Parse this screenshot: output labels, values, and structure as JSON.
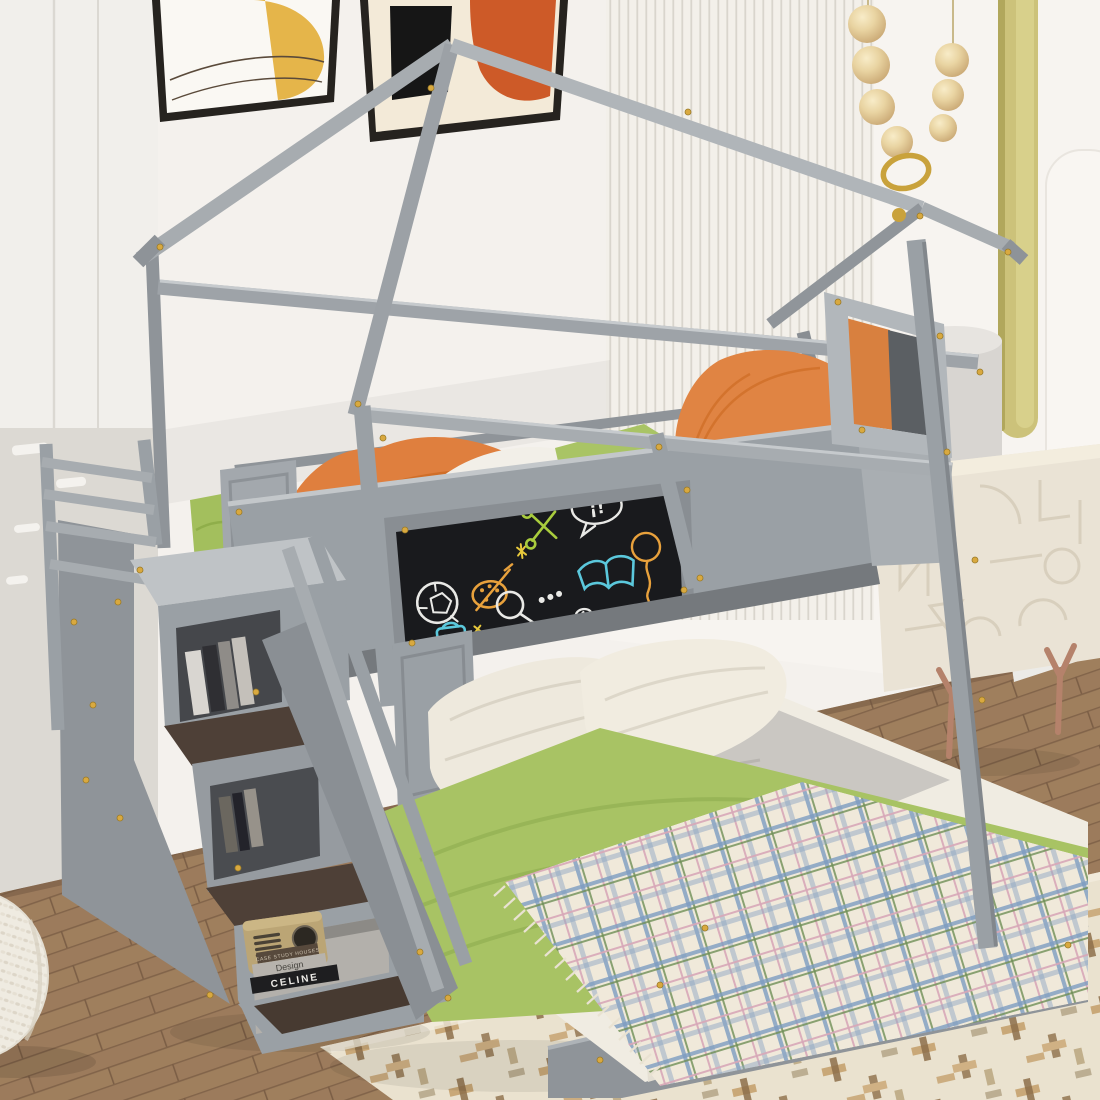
{
  "image_type": "product-lifestyle-photo",
  "subject": "Gray wooden house-shaped twin-over-full bunk loft bed with storage staircase, chalkboard guardrail panel and decorative kids bedroom scene",
  "texts": {
    "book_1": "CASE STUDY HOUSES",
    "book_2": "Design",
    "book_3": "CELINE",
    "chalk_bubble": "¡!"
  },
  "palette": {
    "bed_frame_gray": "#9aa0a5",
    "bed_frame_light": "#c3c7ca",
    "bed_frame_dark": "#7e8388",
    "hardware_gold": "#d9a93f",
    "chalkboard": "#191a1d",
    "chalk_white": "#e9e9e6",
    "chalk_blue": "#5bc8dc",
    "chalk_green": "#a9cc3d",
    "chalk_orange": "#e8a13c",
    "bedding_green": "#a8c364",
    "bedding_orange": "#df7f3e",
    "bedding_white": "#f0ece2",
    "sheet_gray": "#cac7c2",
    "plaid_base": "#f0e9da",
    "plaid_blue": "#7d9cc0",
    "plaid_green": "#6f8f56",
    "plaid_pink": "#d8a8b8",
    "wall": "#f4f1ed",
    "accent_niche_olive": "#ccc27a",
    "wood_floor": "#9c7b5c",
    "rug_cream": "#eae2cf",
    "nightstand_cream": "#eae3d5",
    "nightstand_leg_copper": "#b5826b",
    "bead_cream": "#e9d4a2",
    "gold_ring": "#c9a23c",
    "radio_tan": "#bba575",
    "art_yellow": "#e5b54a",
    "art_orange": "#cd5a28"
  },
  "scene": {
    "wall_art": [
      {
        "name": "abstract print, yellow blob with thin curved lines",
        "frame": "black"
      },
      {
        "name": "abstract print, black bar and orange shape",
        "frame": "black"
      }
    ],
    "decor": [
      "wood bead garland with gold ring",
      "olive recessed wall niche",
      "white pedestal cylinder",
      "cream geometric-pattern nightstand with copper Y legs",
      "white knit pouf",
      "cream patterned area rug",
      "walnut wood plank floor",
      "white slat accent wall",
      "white wardrobe with groove panels"
    ],
    "bed": {
      "frame": "gray house gable frame with gold screw accents",
      "top_bunk_bedding": [
        "green pillow",
        "orange blanket",
        "white duvet",
        "green blanket",
        "orange wedge pillow at window end"
      ],
      "guardrail": "black chalkboard panel with colorful chalk doodles",
      "chalk_doodles": [
        "soccer ball",
        "paint palette with brush",
        "sparkle stars",
        "green scissors",
        "speech bubble",
        "blue open book",
        "balloon",
        "magnifying glass with dots",
        "blue backpack",
        "paperclip"
      ],
      "window": "small gray window frame at foot end",
      "bottom_bunk": [
        "two cream pillows",
        "gray sheet",
        "green blanket",
        "plaid fringe throw",
        "white full mattress",
        "gray platform base"
      ],
      "staircase": {
        "type": "3-step storage staircase with guard ladder and diagonal handrails",
        "contents": [
          "books in cubbies",
          "vintage tan radio",
          "stacked design books",
          "pull-out tray step"
        ]
      }
    }
  }
}
